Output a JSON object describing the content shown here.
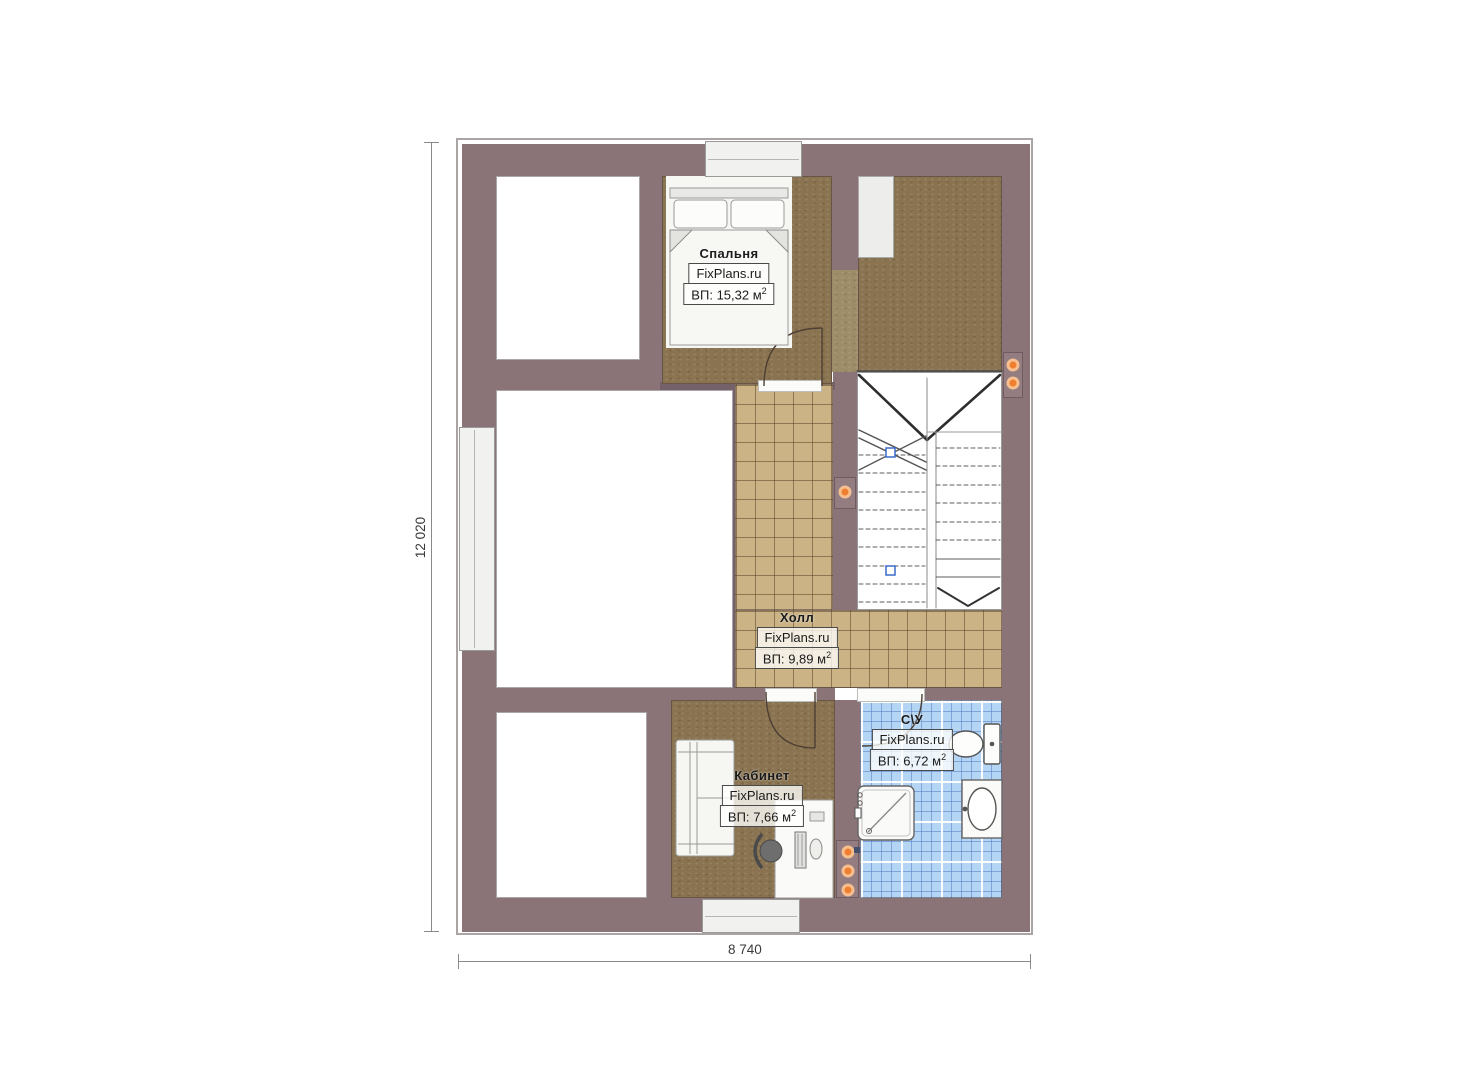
{
  "dimensions": {
    "vertical": "12 020",
    "horizontal": "8 740"
  },
  "watermark": "FixPlans.ru",
  "area_prefix": "ВП:",
  "area_unit": "м",
  "area_sup": "2",
  "rooms": [
    {
      "id": "bedroom",
      "name": "Спальня",
      "area": "15,32"
    },
    {
      "id": "hall",
      "name": "Холл",
      "area": "9,89"
    },
    {
      "id": "office",
      "name": "Кабинет",
      "area": "7,66"
    },
    {
      "id": "bathroom",
      "name": "С\\У",
      "area": "6,72"
    }
  ],
  "colors": {
    "wall": "#8a7478",
    "wood_floor": "#8a7350",
    "wood_light": "#9d8d68",
    "hall_tile": "#cbb386",
    "bath_tile": "#b4d5f3",
    "light_dot": "#ee7f31",
    "stair_marker": "#3a6bc8"
  },
  "icons": {
    "lights": "ceiling-light-dot",
    "stair_markers": "stair-section-marker"
  }
}
